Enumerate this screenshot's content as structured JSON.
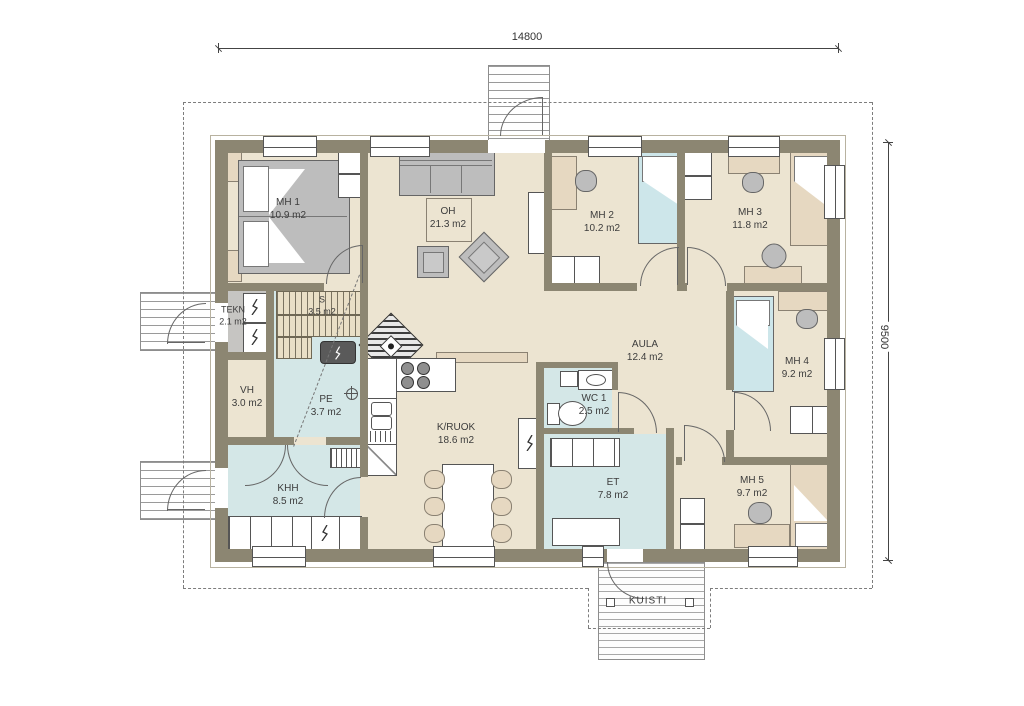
{
  "dimensions": {
    "width": "14800",
    "depth": "9500"
  },
  "rooms": [
    {
      "name": "MH 1",
      "area": "10.9 m2"
    },
    {
      "name": "OH",
      "area": "21.3 m2"
    },
    {
      "name": "MH 2",
      "area": "10.2 m2"
    },
    {
      "name": "MH 3",
      "area": "11.8 m2"
    },
    {
      "name": "TEKN",
      "area": "2.1 m2"
    },
    {
      "name": "S",
      "area": "3.5 m2"
    },
    {
      "name": "VH",
      "area": "3.0 m2"
    },
    {
      "name": "PE",
      "area": "3.7 m2"
    },
    {
      "name": "KHH",
      "area": "8.5 m2"
    },
    {
      "name": "K/RUOK",
      "area": "18.6 m2"
    },
    {
      "name": "AULA",
      "area": "12.4 m2"
    },
    {
      "name": "WC 1",
      "area": "2.5 m2"
    },
    {
      "name": "ET",
      "area": "7.8 m2"
    },
    {
      "name": "MH 4",
      "area": "9.2 m2"
    },
    {
      "name": "MH 5",
      "area": "9.7 m2"
    }
  ],
  "porch": {
    "name": "KUISTI"
  },
  "colors": {
    "wall": "#8c8672",
    "floor": "#ece4d1",
    "wet_floor": "#d4e7e7",
    "tech_floor": "#c6c5c2",
    "wood_bench": "#e9dfc6",
    "furniture_gray": "#bdbdbd",
    "furniture_tan": "#e6d8c1",
    "bed_blue": "#cde6ea",
    "line": "#555555"
  }
}
